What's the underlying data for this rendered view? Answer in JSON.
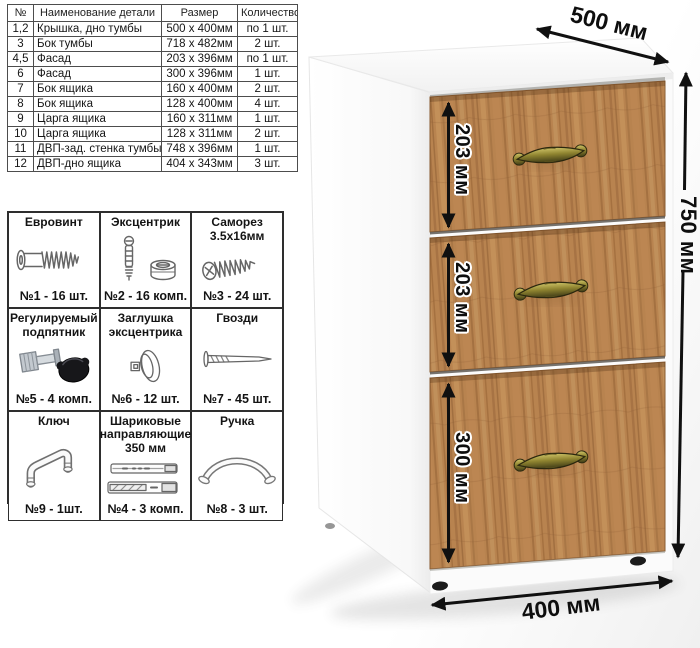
{
  "parts_table": {
    "headers": [
      "№",
      "Наименование детали",
      "Размер",
      "Количество"
    ],
    "rows": [
      [
        "1,2",
        "Крышка, дно тумбы",
        "500 х 400мм",
        "по 1 шт."
      ],
      [
        "3",
        "Бок тумбы",
        "718 х 482мм",
        "2 шт."
      ],
      [
        "4,5",
        "Фасад",
        "203 х 396мм",
        "по 1 шт."
      ],
      [
        "6",
        "Фасад",
        "300 х 396мм",
        "1 шт."
      ],
      [
        "7",
        "Бок ящика",
        "160 х 400мм",
        "2 шт."
      ],
      [
        "8",
        "Бок ящика",
        "128 х 400мм",
        "4 шт."
      ],
      [
        "9",
        "Царга ящика",
        "160 х 311мм",
        "1 шт."
      ],
      [
        "10",
        "Царга ящика",
        "128 х 311мм",
        "2 шт."
      ],
      [
        "11",
        "ДВП-зад. стенка тумбы",
        "748 х 396мм",
        "1 шт."
      ],
      [
        "12",
        "ДВП-дно ящика",
        "404 х 343мм",
        "3 шт."
      ]
    ]
  },
  "hardware_items": [
    {
      "title": "Евровинт",
      "count": "№1 - 16 шт.",
      "icon": "eurovint-screw-icon"
    },
    {
      "title": "Эксцентрик",
      "count": "№2 - 16 комп.",
      "icon": "eccentric-cam-icon"
    },
    {
      "title": "Саморез 3.5х16мм",
      "count": "№3 - 24 шт.",
      "icon": "self-tapping-screw-icon"
    },
    {
      "title": "Регулируемый подпятник",
      "count": "№5 - 4 комп.",
      "icon": "adjustable-foot-icon"
    },
    {
      "title": "Заглушка эксцентрика",
      "count": "№6 - 12 шт.",
      "icon": "cam-cover-icon"
    },
    {
      "title": "Гвозди",
      "count": "№7 - 45 шт.",
      "icon": "nail-icon"
    },
    {
      "title": "Ключ",
      "count": "№9 - 1шт.",
      "icon": "hex-key-icon"
    },
    {
      "title": "Шариковые направляющие 350 мм",
      "count": "№4 - 3 комп.",
      "icon": "ball-slides-icon"
    },
    {
      "title": "Ручка",
      "count": "№8 - 3 шт.",
      "icon": "bow-handle-icon"
    }
  ],
  "cabinet": {
    "depth_label": "500 мм",
    "height_label": "750 мм",
    "width_label": "400 мм",
    "drawer_labels": [
      "203 мм",
      "203 мм",
      "300 мм"
    ],
    "wood_color": "#b8834f",
    "handle_color": "#8f8430",
    "accent_black": "#101010"
  }
}
